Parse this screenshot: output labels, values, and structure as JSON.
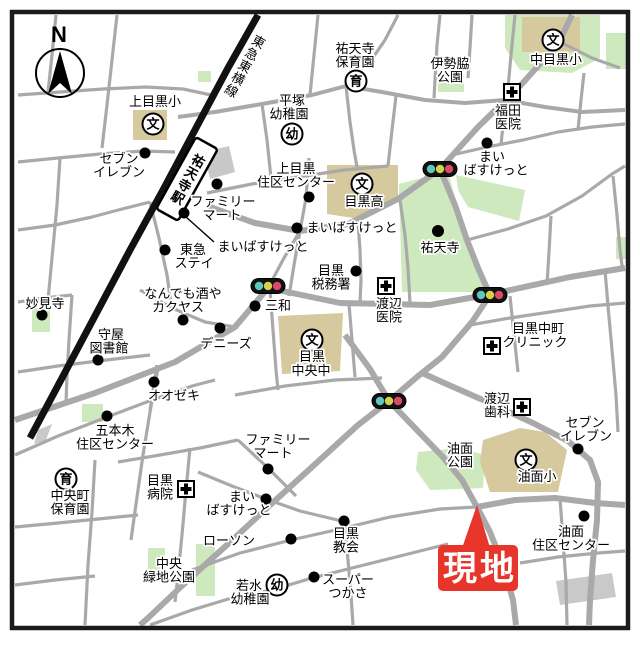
{
  "compass_label": "N",
  "railway_label": "東急東横線",
  "station_label": "祐天寺駅",
  "site_marker": {
    "label": "現地",
    "color": "#e7352c"
  },
  "glyphs": {
    "school": "文",
    "kindergarten": "幼",
    "nursery": "育"
  },
  "colors": {
    "road": "#a9a9a9",
    "railway": "#111111",
    "park_green": "#cde9bd",
    "school_tan": "#d6c99d",
    "plaza_gray": "#c8c8c8",
    "building_gray": "#c9c9c9",
    "signal_teal": "#5ec7c0",
    "signal_yellow": "#d2d24e",
    "signal_red": "#d94a63",
    "frame": "#1a1a1a"
  },
  "labels": {
    "kamimeguro_sho": [
      "上目黒小"
    ],
    "seven_eleven_nw": [
      "セブン",
      "イレブン"
    ],
    "hiratsuka_yochien": [
      "平塚",
      "幼稚園"
    ],
    "yutenji_hoikuen": [
      "祐天寺",
      "保育園"
    ],
    "isewaki_koen": [
      "伊勢脇",
      "公園"
    ],
    "nakameguro_sho": [
      "中目黒小"
    ],
    "fukuda_iin": [
      "福田",
      "医院"
    ],
    "maibasuketto_ne": [
      "まい",
      "ばすけっと"
    ],
    "kamimeguro_jukucenter": [
      "上目黒",
      "住区センター"
    ],
    "meguro_ko": [
      "目黒高"
    ],
    "familymart_n": [
      "ファミリー",
      "マート"
    ],
    "maibasuketto_stn": [
      "まいばすけっと"
    ],
    "maibasuketto_mid": [
      "まいばすけっと"
    ],
    "tokyu_stay": [
      "東急",
      "ステイ"
    ],
    "yutenji_temple": [
      "祐天寺"
    ],
    "meguro_zeimusho": [
      "目黒",
      "税務署"
    ],
    "watanabe_iin": [
      "渡辺",
      "医院"
    ],
    "nandemo_kakuyasu": [
      "なんでも酒や",
      "カクヤス"
    ],
    "sanwa": [
      "三和"
    ],
    "myokenji": [
      "妙見寺"
    ],
    "moriya_toshokan": [
      "守屋",
      "図書館"
    ],
    "dennys": [
      "デニーズ"
    ],
    "meguro_chuo_chu": [
      "目黒",
      "中央中"
    ],
    "meguro_nakamachi_clinic": [
      "目黒中町",
      "クリニック"
    ],
    "watanabe_shika": [
      "渡辺",
      "歯科"
    ],
    "seven_eleven_se": [
      "セブン",
      "イレブン"
    ],
    "aburamen_koen": [
      "油面",
      "公園"
    ],
    "aburamen_sho": [
      "油面小"
    ],
    "oozeki": [
      "オオゼキ"
    ],
    "gohongi_jukucenter": [
      "五本木",
      "住区センター"
    ],
    "chuocho_hoikuen": [
      "中央町",
      "保育園"
    ],
    "meguro_byoin": [
      "目黒",
      "病院"
    ],
    "familymart_s": [
      "ファミリー",
      "マート"
    ],
    "maibasuketto_s": [
      "まい",
      "ばすけっと"
    ],
    "lawson": [
      "ローソン"
    ],
    "meguro_kyokai": [
      "目黒",
      "教会"
    ],
    "chuo_ryokuchi_koen": [
      "中央",
      "緑地公園"
    ],
    "wakamizu_yochien": [
      "若水",
      "幼稚園"
    ],
    "super_tsukasa": [
      "スーパー",
      "つかさ"
    ],
    "aburamen_jukucenter": [
      "油面",
      "住区センター"
    ]
  }
}
